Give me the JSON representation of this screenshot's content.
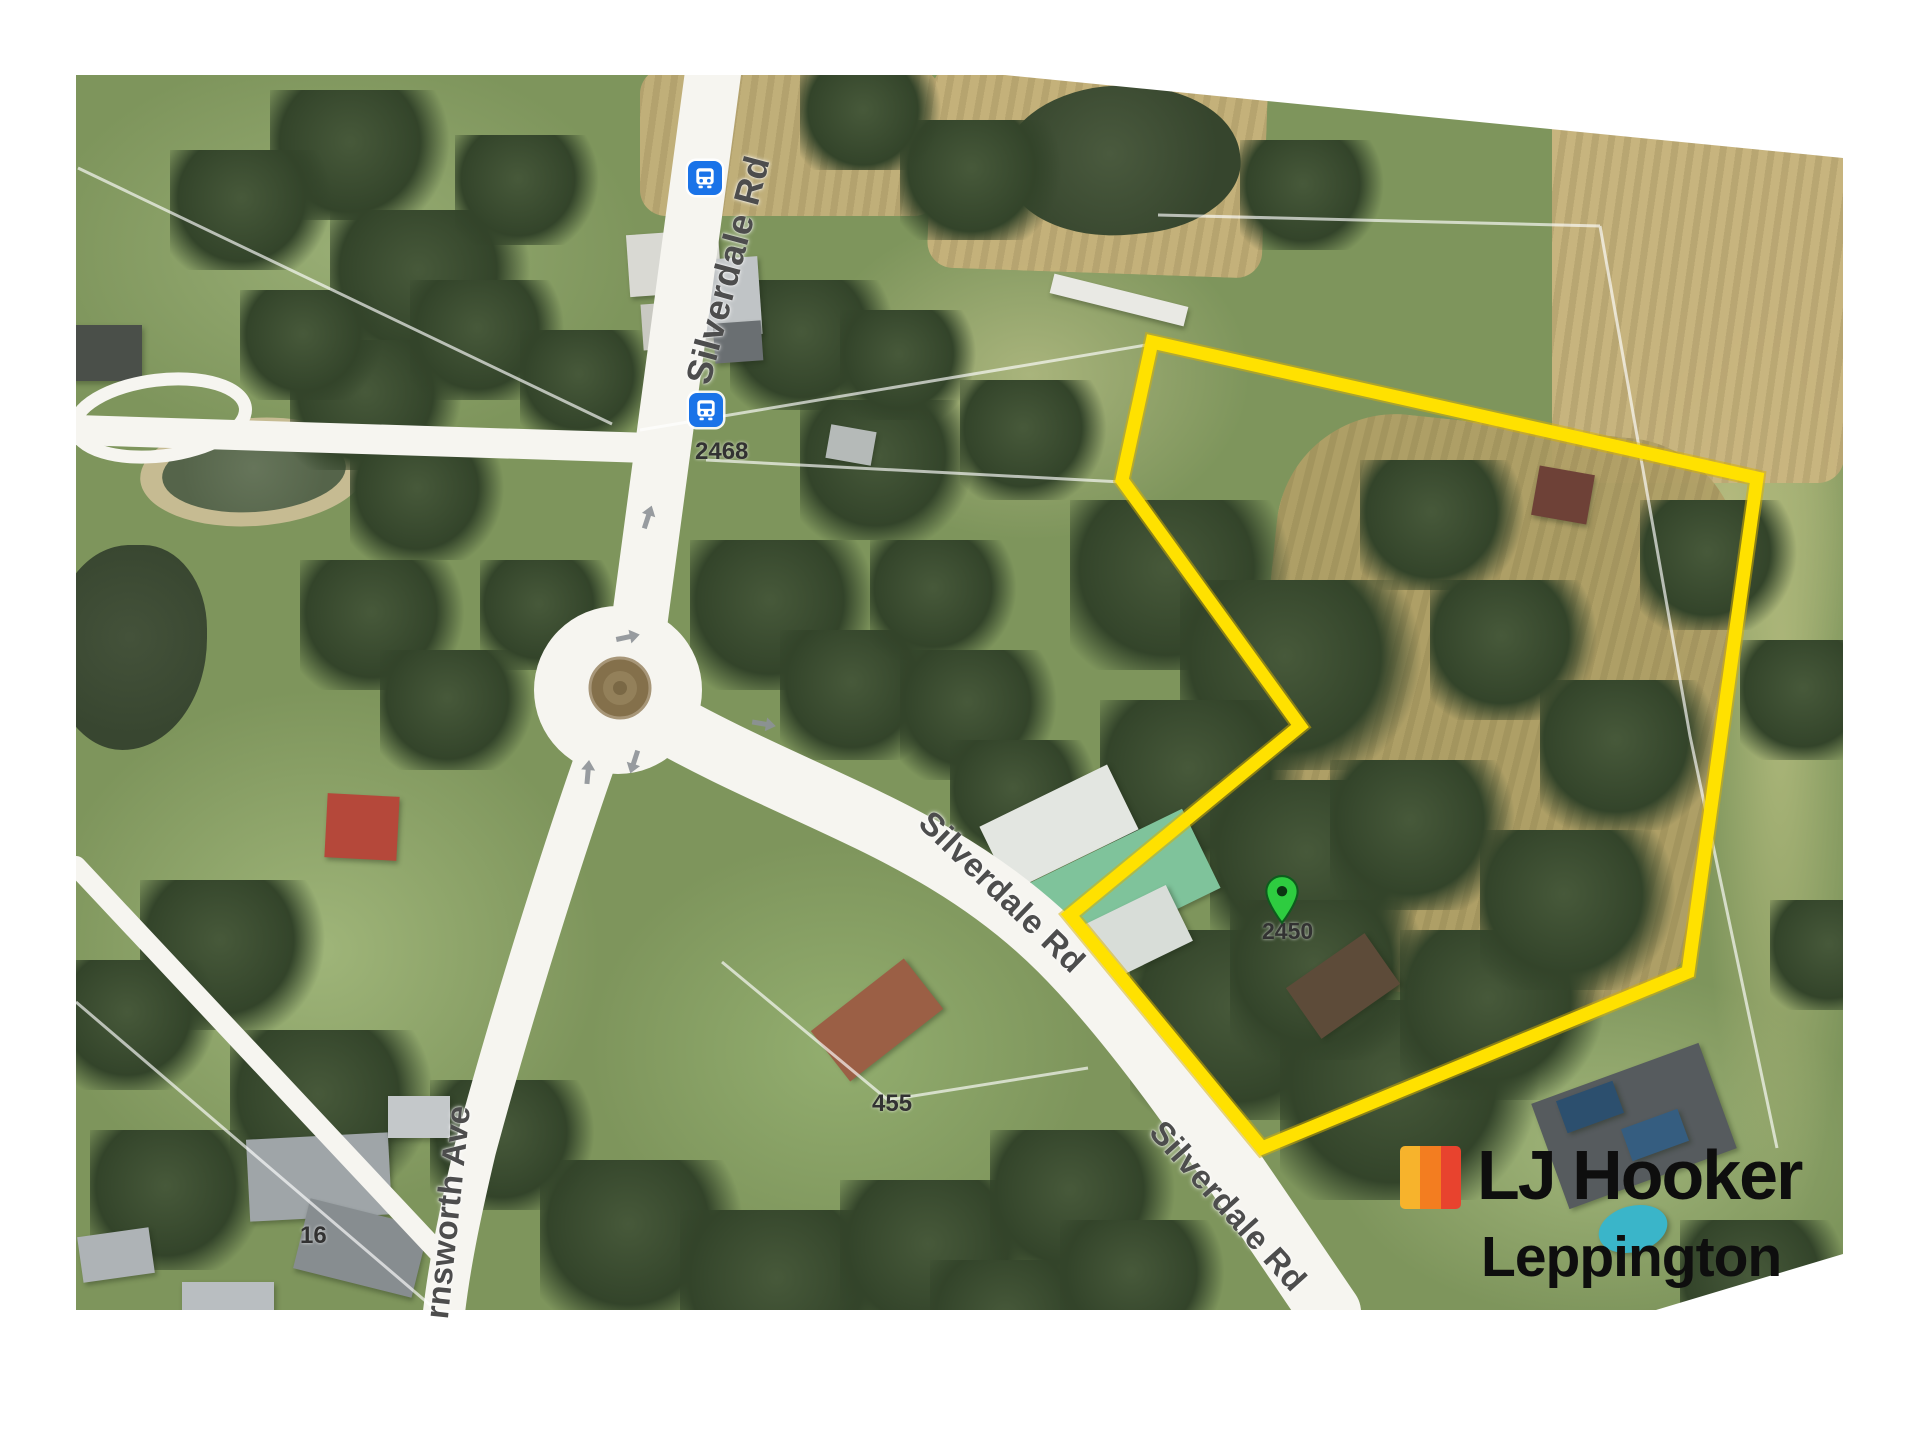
{
  "map": {
    "description_color_base": "#7e955c",
    "road_labels": {
      "silverdale_rd_top": "Silverdale Rd",
      "silverdale_rd_middle": "Silverdale Rd",
      "silverdale_rd_bottom": "Silverdale Rd",
      "farnsworth_ave": "rnsworth Ave"
    },
    "lot_numbers": {
      "lot_2468": "2468",
      "lot_2450": "2450",
      "lot_455": "455",
      "lot_16": "16"
    },
    "marker": {
      "name": "property-location-pin",
      "color": "#2ecc40"
    },
    "boundary": {
      "color": "#ffe100"
    },
    "transit": {
      "bus_stop_color": "#1a73e8",
      "bus_stop_count": 2
    },
    "arrow_color": "#8d9297"
  },
  "branding": {
    "agency": "LJ Hooker",
    "office": "Leppington",
    "logo_stripes": [
      "#F7B32C",
      "#F37D20",
      "#E8432E"
    ]
  }
}
